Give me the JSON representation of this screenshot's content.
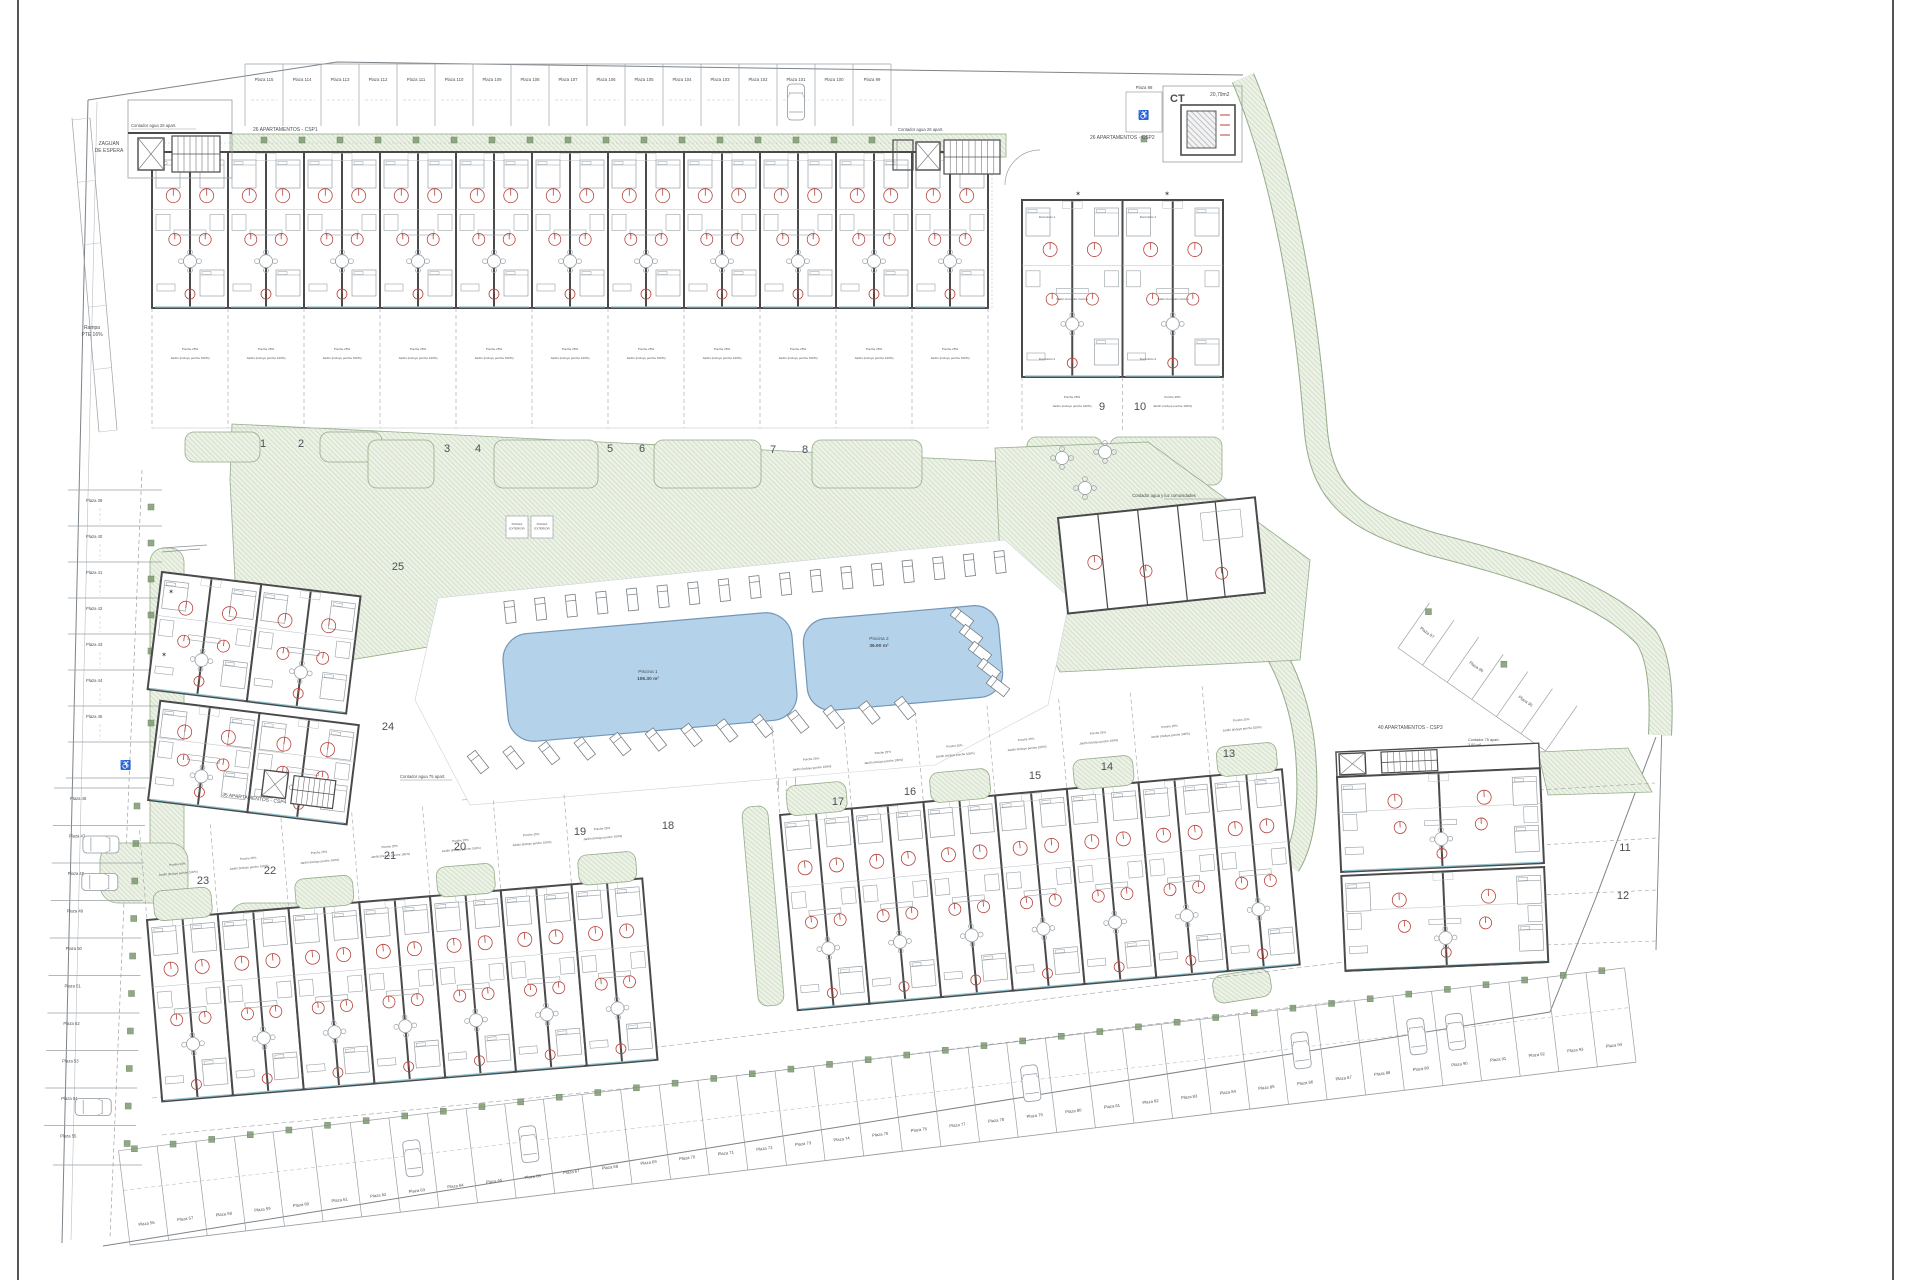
{
  "colors": {
    "wall": "#4a4a4a",
    "thin": "#9aa0a6",
    "faint": "#b9bfc4",
    "furn": "#98a0a6",
    "green_edge": "#94ac88",
    "green_bg": "#edf2e7",
    "green_line": "#ccdac2",
    "marker": "#7d9a70",
    "pool_fill": "#b5d2eb",
    "pool_edge": "#7396b8",
    "red": "#b5433c",
    "window": "#8fc1cf",
    "text": "#4a4f54",
    "dim": "#8a9096"
  },
  "labels": [
    {
      "id": "zaguan-line1",
      "t": "ZAGUAN",
      "x": 109,
      "y": 145,
      "s": 5,
      "a": "m"
    },
    {
      "id": "zaguan-line2",
      "t": "DE ESPERA",
      "x": 109,
      "y": 152,
      "s": 5,
      "a": "m"
    },
    {
      "id": "contador-agua-26-left",
      "t": "Contador agua 26 apart.",
      "x": 131,
      "y": 127,
      "s": 4.2
    },
    {
      "id": "apartamentos-csp1",
      "t": "26 APARTAMENTOS - CSP1",
      "x": 253,
      "y": 131,
      "s": 5
    },
    {
      "id": "contador-agua-26-mid",
      "t": "Contador agua 26 apart.",
      "x": 898,
      "y": 131,
      "s": 4.2
    },
    {
      "id": "apartamentos-csp2",
      "t": "26 APARTAMENTOS - CSP2",
      "x": 1090,
      "y": 139,
      "s": 5
    },
    {
      "id": "ct-title",
      "t": "CT",
      "x": 1170,
      "y": 102,
      "s": 11,
      "w": "bold"
    },
    {
      "id": "ct-area",
      "t": "20,79m2",
      "x": 1210,
      "y": 96,
      "s": 5
    },
    {
      "id": "rampa-line1",
      "t": "Rampa",
      "x": 92,
      "y": 329,
      "s": 5,
      "a": "m"
    },
    {
      "id": "rampa-line2",
      "t": "PTE 16%",
      "x": 92,
      "y": 336,
      "s": 5,
      "a": "m"
    },
    {
      "id": "piscina1-name",
      "t": "Piscina 1",
      "x": 648,
      "y": 673,
      "s": 4.8,
      "a": "m"
    },
    {
      "id": "piscina1-area",
      "t": "106.30 m²",
      "x": 648,
      "y": 680,
      "s": 4.8,
      "a": "m",
      "w": "bold"
    },
    {
      "id": "piscina2-name",
      "t": "Piscina 2",
      "x": 879,
      "y": 640,
      "s": 4.8,
      "a": "m"
    },
    {
      "id": "piscina2-area",
      "t": "36.90 m²",
      "x": 879,
      "y": 647,
      "s": 4.8,
      "a": "m",
      "w": "bold"
    },
    {
      "id": "contador-comunidades",
      "t": "Contador agua y luz comunidades",
      "x": 1164,
      "y": 497,
      "s": 4.2,
      "a": "m"
    },
    {
      "id": "apartamentos-csp4",
      "t": "35 APARTAMENTOS - CSP4",
      "x": 222,
      "y": 796,
      "s": 5,
      "r": 7
    },
    {
      "id": "contador-agua-75",
      "t": "Contador agua 75 apart.",
      "x": 400,
      "y": 778,
      "s": 4.2
    },
    {
      "id": "apartamentos-csp3",
      "t": "40 APARTAMENTOS - CSP3",
      "x": 1378,
      "y": 729,
      "s": 5
    },
    {
      "id": "contador-75",
      "t": "Contador 75 apart.",
      "x": 1468,
      "y": 741,
      "s": 3.8
    },
    {
      "id": "contador-75-area",
      "t": "3.00 m²",
      "x": 1468,
      "y": 746,
      "s": 3.8
    },
    {
      "id": "star-1",
      "t": "✶",
      "x": 1078,
      "y": 196,
      "s": 7,
      "a": "m"
    },
    {
      "id": "star-2",
      "t": "✶",
      "x": 1167,
      "y": 196,
      "s": 7,
      "a": "m"
    },
    {
      "id": "star-3",
      "t": "✶",
      "x": 171,
      "y": 594,
      "s": 7,
      "a": "m"
    },
    {
      "id": "star-4",
      "t": "✶",
      "x": 164,
      "y": 657,
      "s": 7,
      "a": "m"
    }
  ],
  "ducha": {
    "line1": "DUCHA",
    "line2": "EXTERIOR"
  },
  "garden_caption": {
    "porche": "Porche 25%",
    "jardin": "Jardín (incluye porche 100%)"
  },
  "rooms": {
    "salon": "Salón-Comedor-Cocina",
    "d1": "Dormitorio 1",
    "d2": "Dormitorio 2"
  },
  "parking": {
    "top": [
      "Plaza 115",
      "Plaza 114",
      "Plaza 113",
      "Plaza 112",
      "Plaza 111",
      "Plaza 110",
      "Plaza 109",
      "Plaza 108",
      "Plaza 107",
      "Plaza 106",
      "Plaza 105",
      "Plaza 104",
      "Plaza 103",
      "Plaza 102",
      "Plaza 101",
      "Plaza 100",
      "Plaza 99"
    ],
    "standalone": "Plaza 98",
    "left": [
      "Plaza 39",
      "Plaza 40",
      "Plaza 41",
      "Plaza 42",
      "Plaza 43",
      "Plaza 44",
      "Plaza 45",
      "Plaza 46",
      "Plaza 47",
      "Plaza 48",
      "Plaza 49",
      "Plaza 50",
      "Plaza 51",
      "Plaza 52",
      "Plaza 53",
      "Plaza 54",
      "Plaza 55"
    ],
    "bottom": [
      "Plaza 56",
      "Plaza 57",
      "Plaza 58",
      "Plaza 59",
      "Plaza 60",
      "Plaza 61",
      "Plaza 62",
      "Plaza 63",
      "Plaza 64",
      "Plaza 65",
      "Plaza 66",
      "Plaza 67",
      "Plaza 68",
      "Plaza 69",
      "Plaza 70",
      "Plaza 71",
      "Plaza 72",
      "Plaza 73",
      "Plaza 74",
      "Plaza 75",
      "Plaza 76",
      "Plaza 77",
      "Plaza 78",
      "Plaza 79",
      "Plaza 80",
      "Plaza 81",
      "Plaza 82",
      "Plaza 83",
      "Plaza 84",
      "Plaza 85",
      "Plaza 86",
      "Plaza 87",
      "Plaza 88",
      "Plaza 89",
      "Plaza 90",
      "Plaza 91",
      "Plaza 92",
      "Plaza 93",
      "Plaza 94"
    ],
    "diagonal": [
      "Plaza 97",
      "Plaza 96",
      "Plaza 95"
    ]
  },
  "garden_numbers": [
    "1",
    "2",
    "3",
    "4",
    "5",
    "6",
    "7",
    "8",
    "9",
    "10",
    "11",
    "12",
    "13",
    "14",
    "15",
    "16",
    "17",
    "18",
    "19",
    "20",
    "21",
    "22",
    "23",
    "24",
    "25"
  ]
}
